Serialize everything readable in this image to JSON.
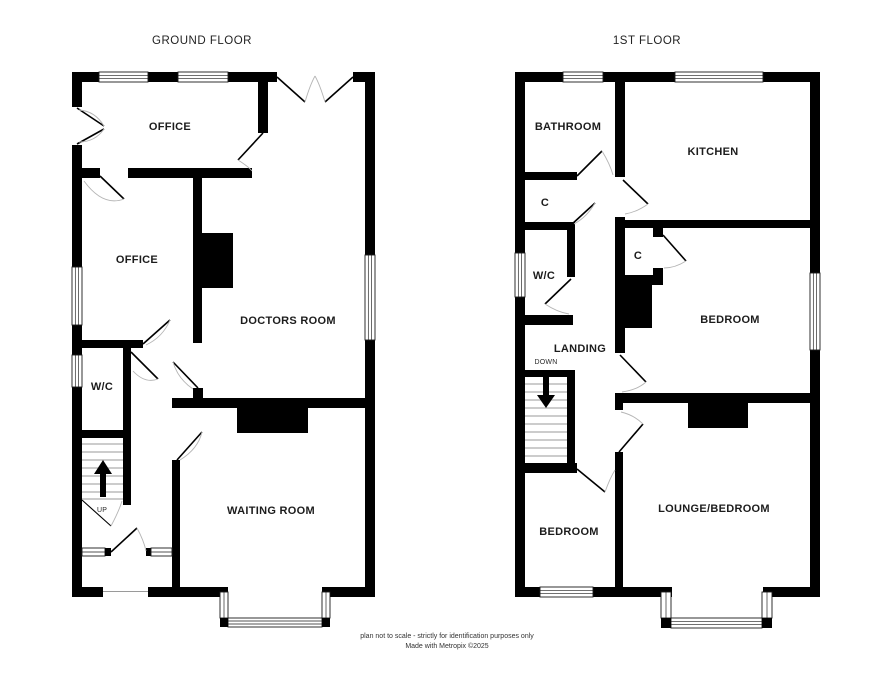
{
  "document": {
    "type": "floorplan",
    "colors": {
      "wall": "#000000",
      "background": "#ffffff",
      "label_text": "#1c1c1c",
      "door_arc": "#b5b5b5",
      "stair_tread": "#777777"
    }
  },
  "ground_floor": {
    "title": "GROUND FLOOR",
    "rooms": {
      "office_top": "OFFICE",
      "office_mid": "OFFICE",
      "doctors_room": "DOCTORS ROOM",
      "wc": "W/C",
      "waiting_room": "WAITING ROOM"
    },
    "stairs": {
      "direction_label": "UP"
    }
  },
  "first_floor": {
    "title": "1ST FLOOR",
    "rooms": {
      "bathroom": "BATHROOM",
      "kitchen": "KITCHEN",
      "cupboard_left": "C",
      "wc": "W/C",
      "cupboard_right": "C",
      "bedroom": "BEDROOM",
      "landing": "LANDING",
      "lounge_bedroom": "LOUNGE/BEDROOM",
      "bedroom_front": "BEDROOM"
    },
    "stairs": {
      "direction_label": "DOWN"
    }
  },
  "footer": {
    "line1": "plan not to scale - strictly for identification purposes only",
    "line2": "Made with Metropix ©2025"
  }
}
